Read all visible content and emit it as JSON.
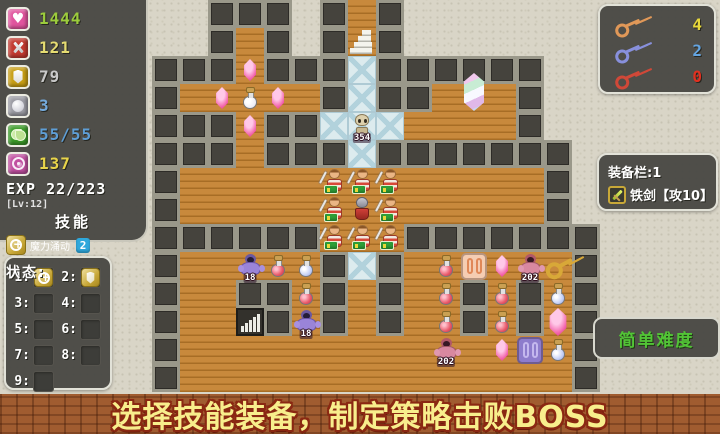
{
  "stats": {
    "rows": [
      {
        "name": "hp",
        "icon": "heart-icon",
        "value": "1444",
        "value_color": "#9ccc3c",
        "icon_bg": "#e0559e"
      },
      {
        "name": "attack",
        "icon": "sword-icon",
        "value": "121",
        "value_color": "#e6dc72",
        "icon_bg": "#c23a30"
      },
      {
        "name": "defense",
        "icon": "shield-icon",
        "value": "79",
        "value_color": "#c9c9c9",
        "icon_bg": "#c79e16"
      },
      {
        "name": "silver",
        "icon": "coin-icon",
        "value": "3",
        "value_color": "#74aadc",
        "icon_bg": "#9b9ba3"
      },
      {
        "name": "money",
        "icon": "money-icon",
        "value": "55/55",
        "value_color": "#5e9ed6",
        "icon_bg": "#3b9a28"
      },
      {
        "name": "magic",
        "icon": "spiral-icon",
        "value": "137",
        "value_color": "#e8d44a",
        "icon_bg": "#c050a0"
      }
    ],
    "exp_label": "EXP",
    "exp_value": "22/223",
    "level": "[Lv:12]",
    "skills_title": "技能",
    "skill_name": "魔力涌动",
    "skill_count": "2",
    "status_label": "状态:"
  },
  "keys": {
    "items": [
      {
        "name": "yellow-key",
        "count": "4",
        "key_color": "#e09858",
        "count_color": "#e8d83a"
      },
      {
        "name": "blue-key",
        "count": "2",
        "key_color": "#8890dc",
        "count_color": "#64a4e0"
      },
      {
        "name": "red-key",
        "count": "0",
        "key_color": "#d04838",
        "count_color": "#e03020"
      }
    ]
  },
  "equipment": {
    "title": "装备栏:1",
    "item_name": "铁剑【攻10】"
  },
  "difficulty_label": "简单难度",
  "slots": {
    "items": [
      {
        "num": "1:",
        "icon": "skill-plus-icon"
      },
      {
        "num": "2:",
        "icon": "skill-guard-icon"
      },
      {
        "num": "3:",
        "icon": ""
      },
      {
        "num": "4:",
        "icon": ""
      },
      {
        "num": "5:",
        "icon": ""
      },
      {
        "num": "6:",
        "icon": ""
      },
      {
        "num": "7:",
        "icon": ""
      },
      {
        "num": "8:",
        "icon": ""
      },
      {
        "num": "9:",
        "icon": ""
      }
    ]
  },
  "banner_text": "选择技能装备，制定策略击败BOSS",
  "map": {
    "tile_size": 28,
    "origin_x": 152,
    "origin_y": 0,
    "grid": [
      ".......w........",
      "...w...u........",
      "...w...i........",
      ".wwwww.i..www...",
      "...w..iiiwwww...",
      "...w...i........",
      ".wwwwwwwwwwwww..",
      ".wwwwwwwwwwwww..",
      "......www.......",
      ".wwwww#i#wwwwww.",
      ".ww##w#w#ww#w#w.",
      ".wwd#w#w#ww#w#w.",
      ".wwwwwwwwwwwwww.",
      ".wwwwwwwwwwwwww."
    ],
    "entities": [
      {
        "type": "gem",
        "col": 3,
        "row": 2
      },
      {
        "type": "gem",
        "col": 2,
        "row": 3
      },
      {
        "type": "potion-white",
        "col": 3,
        "row": 3
      },
      {
        "type": "gem",
        "col": 4,
        "row": 3
      },
      {
        "type": "gem",
        "col": 3,
        "row": 4
      },
      {
        "type": "skeleton",
        "col": 7,
        "row": 4,
        "label": "354"
      },
      {
        "type": "crystal",
        "col": 11,
        "row": 3
      },
      {
        "type": "warrior",
        "col": 6,
        "row": 6
      },
      {
        "type": "warrior",
        "col": 7,
        "row": 6
      },
      {
        "type": "warrior",
        "col": 8,
        "row": 6
      },
      {
        "type": "warrior",
        "col": 6,
        "row": 7
      },
      {
        "type": "hero",
        "col": 7,
        "row": 7
      },
      {
        "type": "warrior",
        "col": 8,
        "row": 7
      },
      {
        "type": "warrior",
        "col": 6,
        "row": 8
      },
      {
        "type": "warrior",
        "col": 7,
        "row": 8
      },
      {
        "type": "warrior",
        "col": 8,
        "row": 8
      },
      {
        "type": "mage",
        "col": 3,
        "row": 9,
        "label": "18"
      },
      {
        "type": "potion-red",
        "col": 4,
        "row": 9
      },
      {
        "type": "potion-blue",
        "col": 5,
        "row": 9
      },
      {
        "type": "potion-red",
        "col": 5,
        "row": 10
      },
      {
        "type": "mage",
        "col": 5,
        "row": 11,
        "label": "18"
      },
      {
        "type": "potion-red",
        "col": 10,
        "row": 9
      },
      {
        "type": "potion-red",
        "col": 10,
        "row": 10
      },
      {
        "type": "potion-red",
        "col": 10,
        "row": 11
      },
      {
        "type": "monster",
        "col": 10,
        "row": 12,
        "label": "202"
      },
      {
        "type": "door-orange",
        "col": 11,
        "row": 9
      },
      {
        "type": "gem",
        "col": 12,
        "row": 9
      },
      {
        "type": "monster",
        "col": 13,
        "row": 9,
        "label": "202"
      },
      {
        "type": "key-item",
        "col": 14,
        "row": 9
      },
      {
        "type": "potion-red",
        "col": 12,
        "row": 10
      },
      {
        "type": "potion-red",
        "col": 12,
        "row": 11
      },
      {
        "type": "gem",
        "col": 12,
        "row": 12
      },
      {
        "type": "door-purple",
        "col": 13,
        "row": 12
      },
      {
        "type": "potion-blue",
        "col": 14,
        "row": 10
      },
      {
        "type": "big-gem",
        "col": 14,
        "row": 11
      },
      {
        "type": "potion-blue",
        "col": 14,
        "row": 12
      }
    ]
  }
}
